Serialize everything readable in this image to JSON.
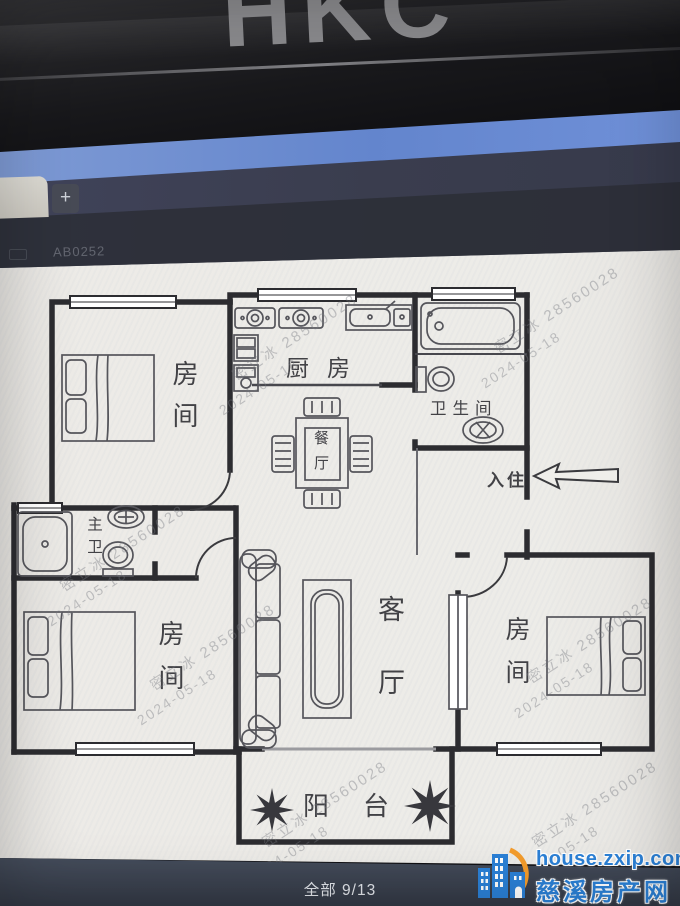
{
  "monitor": {
    "brand": "HKC"
  },
  "browser": {
    "new_tab_label": "+",
    "faint_text": "AB0252"
  },
  "plan": {
    "bedroom_tl": "房间",
    "kitchen": "厨房",
    "bathroom": "卫生间",
    "dining": "餐厅",
    "entry": "入住",
    "master_bath": "主卫",
    "bedroom_bl": "房间",
    "living": "客厅",
    "bedroom_r": "房间",
    "balcony": "阳台",
    "watermark": {
      "line1": "密立冰 28560028",
      "line2": "2024-05-18"
    }
  },
  "viewer": {
    "counter": "全部 9/13"
  },
  "badge": {
    "domain": "house.zxip.com",
    "site_name": "慈溪房产网",
    "accent_blue": "#2b80d6",
    "accent_orange": "#f39c2c"
  }
}
